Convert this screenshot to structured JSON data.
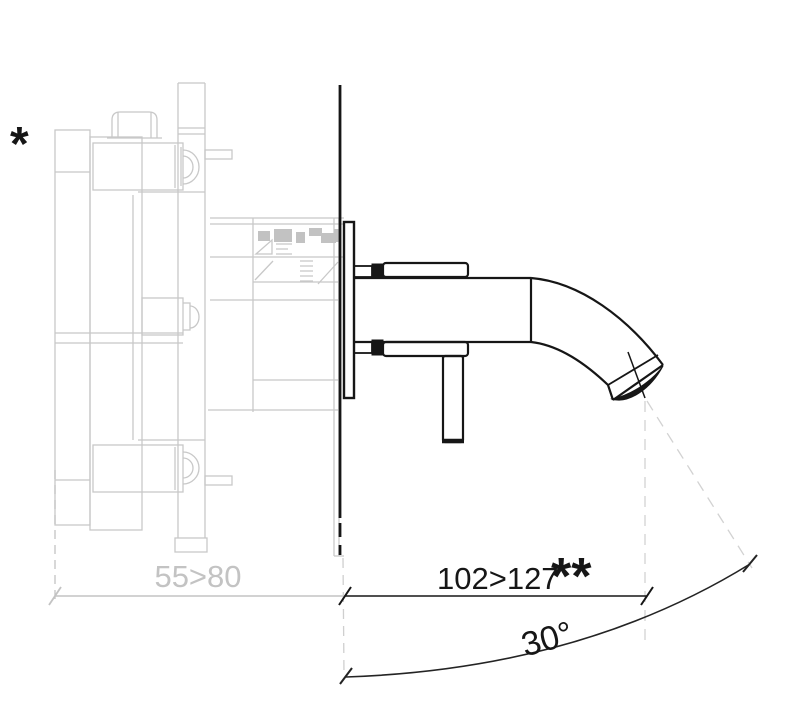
{
  "diagram": {
    "kind": "technical-drawing-side-section",
    "subject": "wall-mounted-spout-with-concealed-valve",
    "labels": {
      "footnote_star": "*",
      "recess_depth": "55>80",
      "projection": "102>127",
      "projection_footnote": "**",
      "stream_angle": "30°"
    },
    "colors": {
      "foreground": "#161616",
      "concealed_gray": "#c8c8c8",
      "hatch_gray": "#c2c2c2",
      "dimension_gray": "#c3c3c3",
      "dashed_gray": "#d2d2d2",
      "background": "#ffffff"
    }
  }
}
